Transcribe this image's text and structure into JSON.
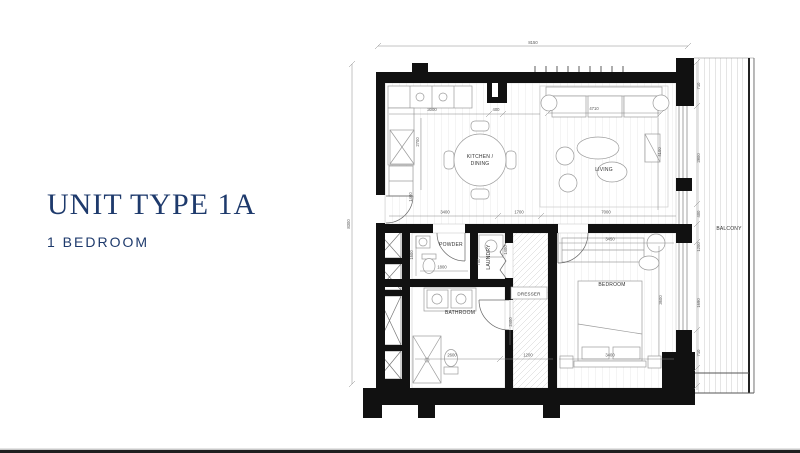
{
  "header": {
    "title": "UNIT TYPE 1A",
    "subtitle": "1 BEDROOM"
  },
  "colors": {
    "accent_navy": "#1e3a6c",
    "wall_black": "#111111",
    "drawing_gray": "#9b9b9b"
  },
  "plan": {
    "labels": {
      "kitchen_line1": "KITCHEN /",
      "kitchen_line2": "DINING",
      "living": "LIVING",
      "bedroom": "BEDROOM",
      "bathroom": "BATHROOM",
      "powder": "POWDER",
      "laundry": "LAUNDRY",
      "dresser": "DRESSER",
      "balcony": "BALCONY"
    },
    "dims": {
      "overall_top": "8150",
      "overall_left": "8300",
      "kitchen_run": "3000",
      "kitchen_niche": "400",
      "sofa_width": "4710",
      "kitchen_depth": "2700",
      "entry_width": "1400",
      "kitchen_base": "3400",
      "hall_top": "1700",
      "living_width": "7000",
      "living_depth": "4100",
      "bedroom_top": "3450",
      "bedroom_depth": "3600",
      "bedroom_base": "3400",
      "powder_depth": "1500",
      "powder_width": "1800",
      "laundry_width": "700",
      "laundry_depth": "1400",
      "bathroom_width": "2600",
      "bathroom_depth": "2400",
      "hall_base": "1200",
      "balcony_1": "710",
      "balcony_2": "2800",
      "balcony_3": "400",
      "balcony_4": "1200",
      "balcony_5": "1690",
      "balcony_6": "710"
    }
  }
}
